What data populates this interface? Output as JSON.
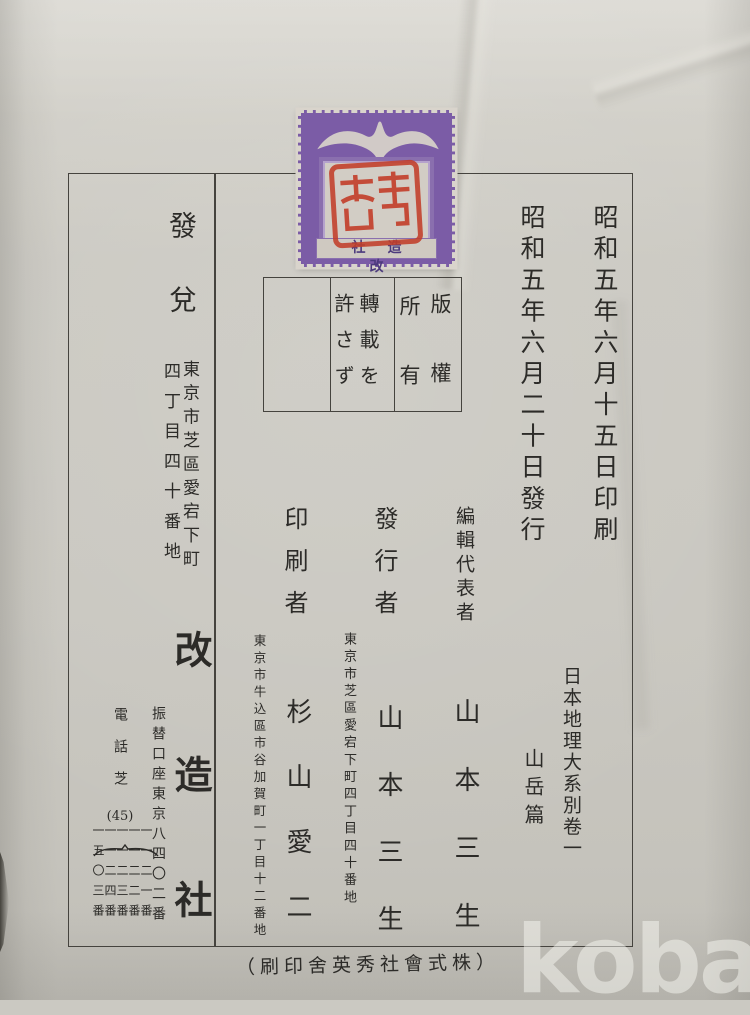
{
  "photo": {
    "watermark": "kobay"
  },
  "colophon": {
    "date_printed": "昭和五年六月十五日印刷",
    "date_published": "昭和五年六月二十日發行",
    "series_title": "日本地理大系別卷一",
    "series_volume": "山岳篇",
    "rights": {
      "col_1": "版權",
      "col_2": "所有",
      "col_3": "轉載を",
      "col_4": "許さず"
    },
    "editor": {
      "label": "編輯代表者",
      "name": "山本三生"
    },
    "publisher": {
      "label": "發行者",
      "address": "東京市芝區愛宕下町四丁目四十番地",
      "name": "山本三生"
    },
    "printer": {
      "label": "印刷者",
      "address": "東京市牛込區市谷加賀町一丁目十二番地",
      "name": "杉山愛二"
    },
    "distributor": {
      "label": "發兌",
      "address_line_1": "東京市芝區愛宕下町",
      "address_line_2": "四丁目四十番地",
      "name": "改造社",
      "postal_account": "振替口座東京八四〇二番",
      "telephone_label": "電話芝",
      "telephone_exchange": "(45)",
      "telephone_numbers": [
        "一一二一番",
        "一一二二番",
        "一一二三番",
        "一一二四番",
        "一五〇三番"
      ]
    },
    "printing_company_note": "（刷印舍英秀社會式株）"
  },
  "stamp": {
    "company": "社造改"
  },
  "colors": {
    "paper": "#cbc9c2",
    "ink": "#2c2b28",
    "stamp_purple": "#7b5ca6",
    "seal_red": "#c23d29"
  }
}
